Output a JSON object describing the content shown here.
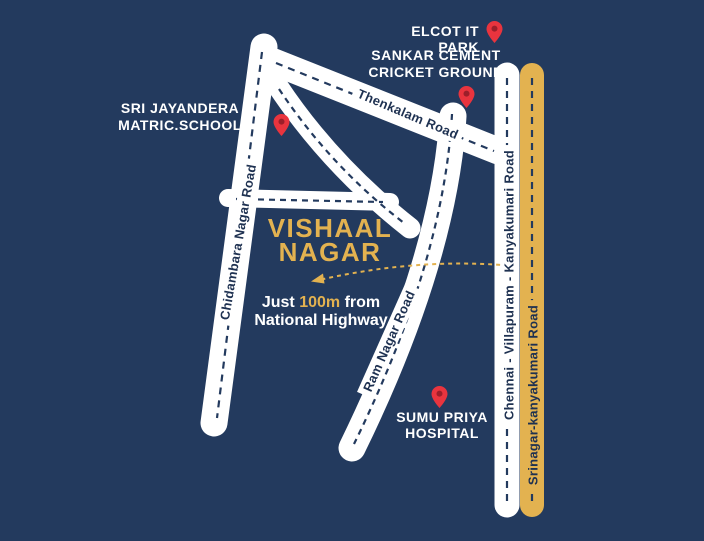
{
  "colors": {
    "background": "#233A5E",
    "road": "#FFFFFF",
    "highlight": "#E3B250",
    "road_text": "#1E3151",
    "pin": "#E9343E",
    "pin_inner": "#9C1F2A",
    "label_text": "#FFFFFF"
  },
  "title": {
    "lines": [
      "VISHAAL",
      "NAGAR"
    ]
  },
  "distance_note": {
    "prefix": "Just ",
    "highlight": "100m",
    "suffix": " from",
    "line2": "National Highway"
  },
  "landmarks": {
    "elcot": {
      "label": "ELCOT IT PARK"
    },
    "sankar": {
      "lines": [
        "SANKAR CEMENT",
        "CRICKET GROUND"
      ]
    },
    "school": {
      "lines": [
        "SRI JAYANDERA",
        "MATRIC.SCHOOL"
      ]
    },
    "hospital": {
      "lines": [
        "SUMU PRIYA",
        "HOSPITAL"
      ]
    }
  },
  "roads": {
    "thenkalam": {
      "label": "Thenkalam Road"
    },
    "chidambara": {
      "label": "Chidambara Nagar Road"
    },
    "ram_nagar": {
      "label": "Ram Nagar Road"
    },
    "chennai": {
      "label": "Chennai - Villapuram - Kanyakumari Road"
    },
    "srinagar": {
      "label": "Srinagar-kanyakumari Road"
    }
  }
}
